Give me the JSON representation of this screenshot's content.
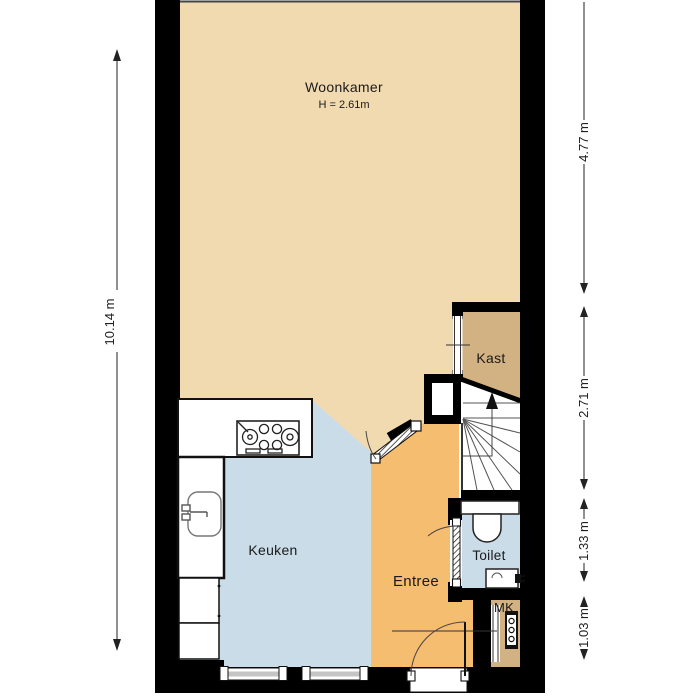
{
  "floorplan": {
    "rooms": {
      "woonkamer": {
        "label": "Woonkamer",
        "height_note": "H = 2.61m",
        "floor_color": "#F1DAB0"
      },
      "kast": {
        "label": "Kast",
        "floor_color": "#D2B283"
      },
      "keuken": {
        "label": "Keuken",
        "floor_color": "#CBDCE9"
      },
      "entree": {
        "label": "Entree",
        "floor_color": "#F4BD6F"
      },
      "toilet": {
        "label": "Toilet",
        "floor_color": "#CBDCE9"
      },
      "mk": {
        "label": "MK",
        "floor_color": "#D2B283"
      }
    },
    "dimensions": {
      "left_total": "10.14 m",
      "right_segments": [
        "4.77 m",
        "2.71 m",
        "1.33 m",
        "1.03 m"
      ]
    },
    "fixtures": [
      "stove-icon",
      "kitchen-sink-icon",
      "toilet-icon",
      "hand-basin-icon",
      "meter-panel-icon",
      "stair-up-arrow-icon",
      "window-icon",
      "door-swing-icon"
    ],
    "colors": {
      "wall": "#000000",
      "living_tan": "#F1DAB0",
      "closet_brown": "#D2B283",
      "kitchen_blue": "#CBDCE9",
      "entry_orange": "#F4BD6F",
      "window_glass": "#C5C5C5",
      "dimension_text": "#222222"
    }
  }
}
